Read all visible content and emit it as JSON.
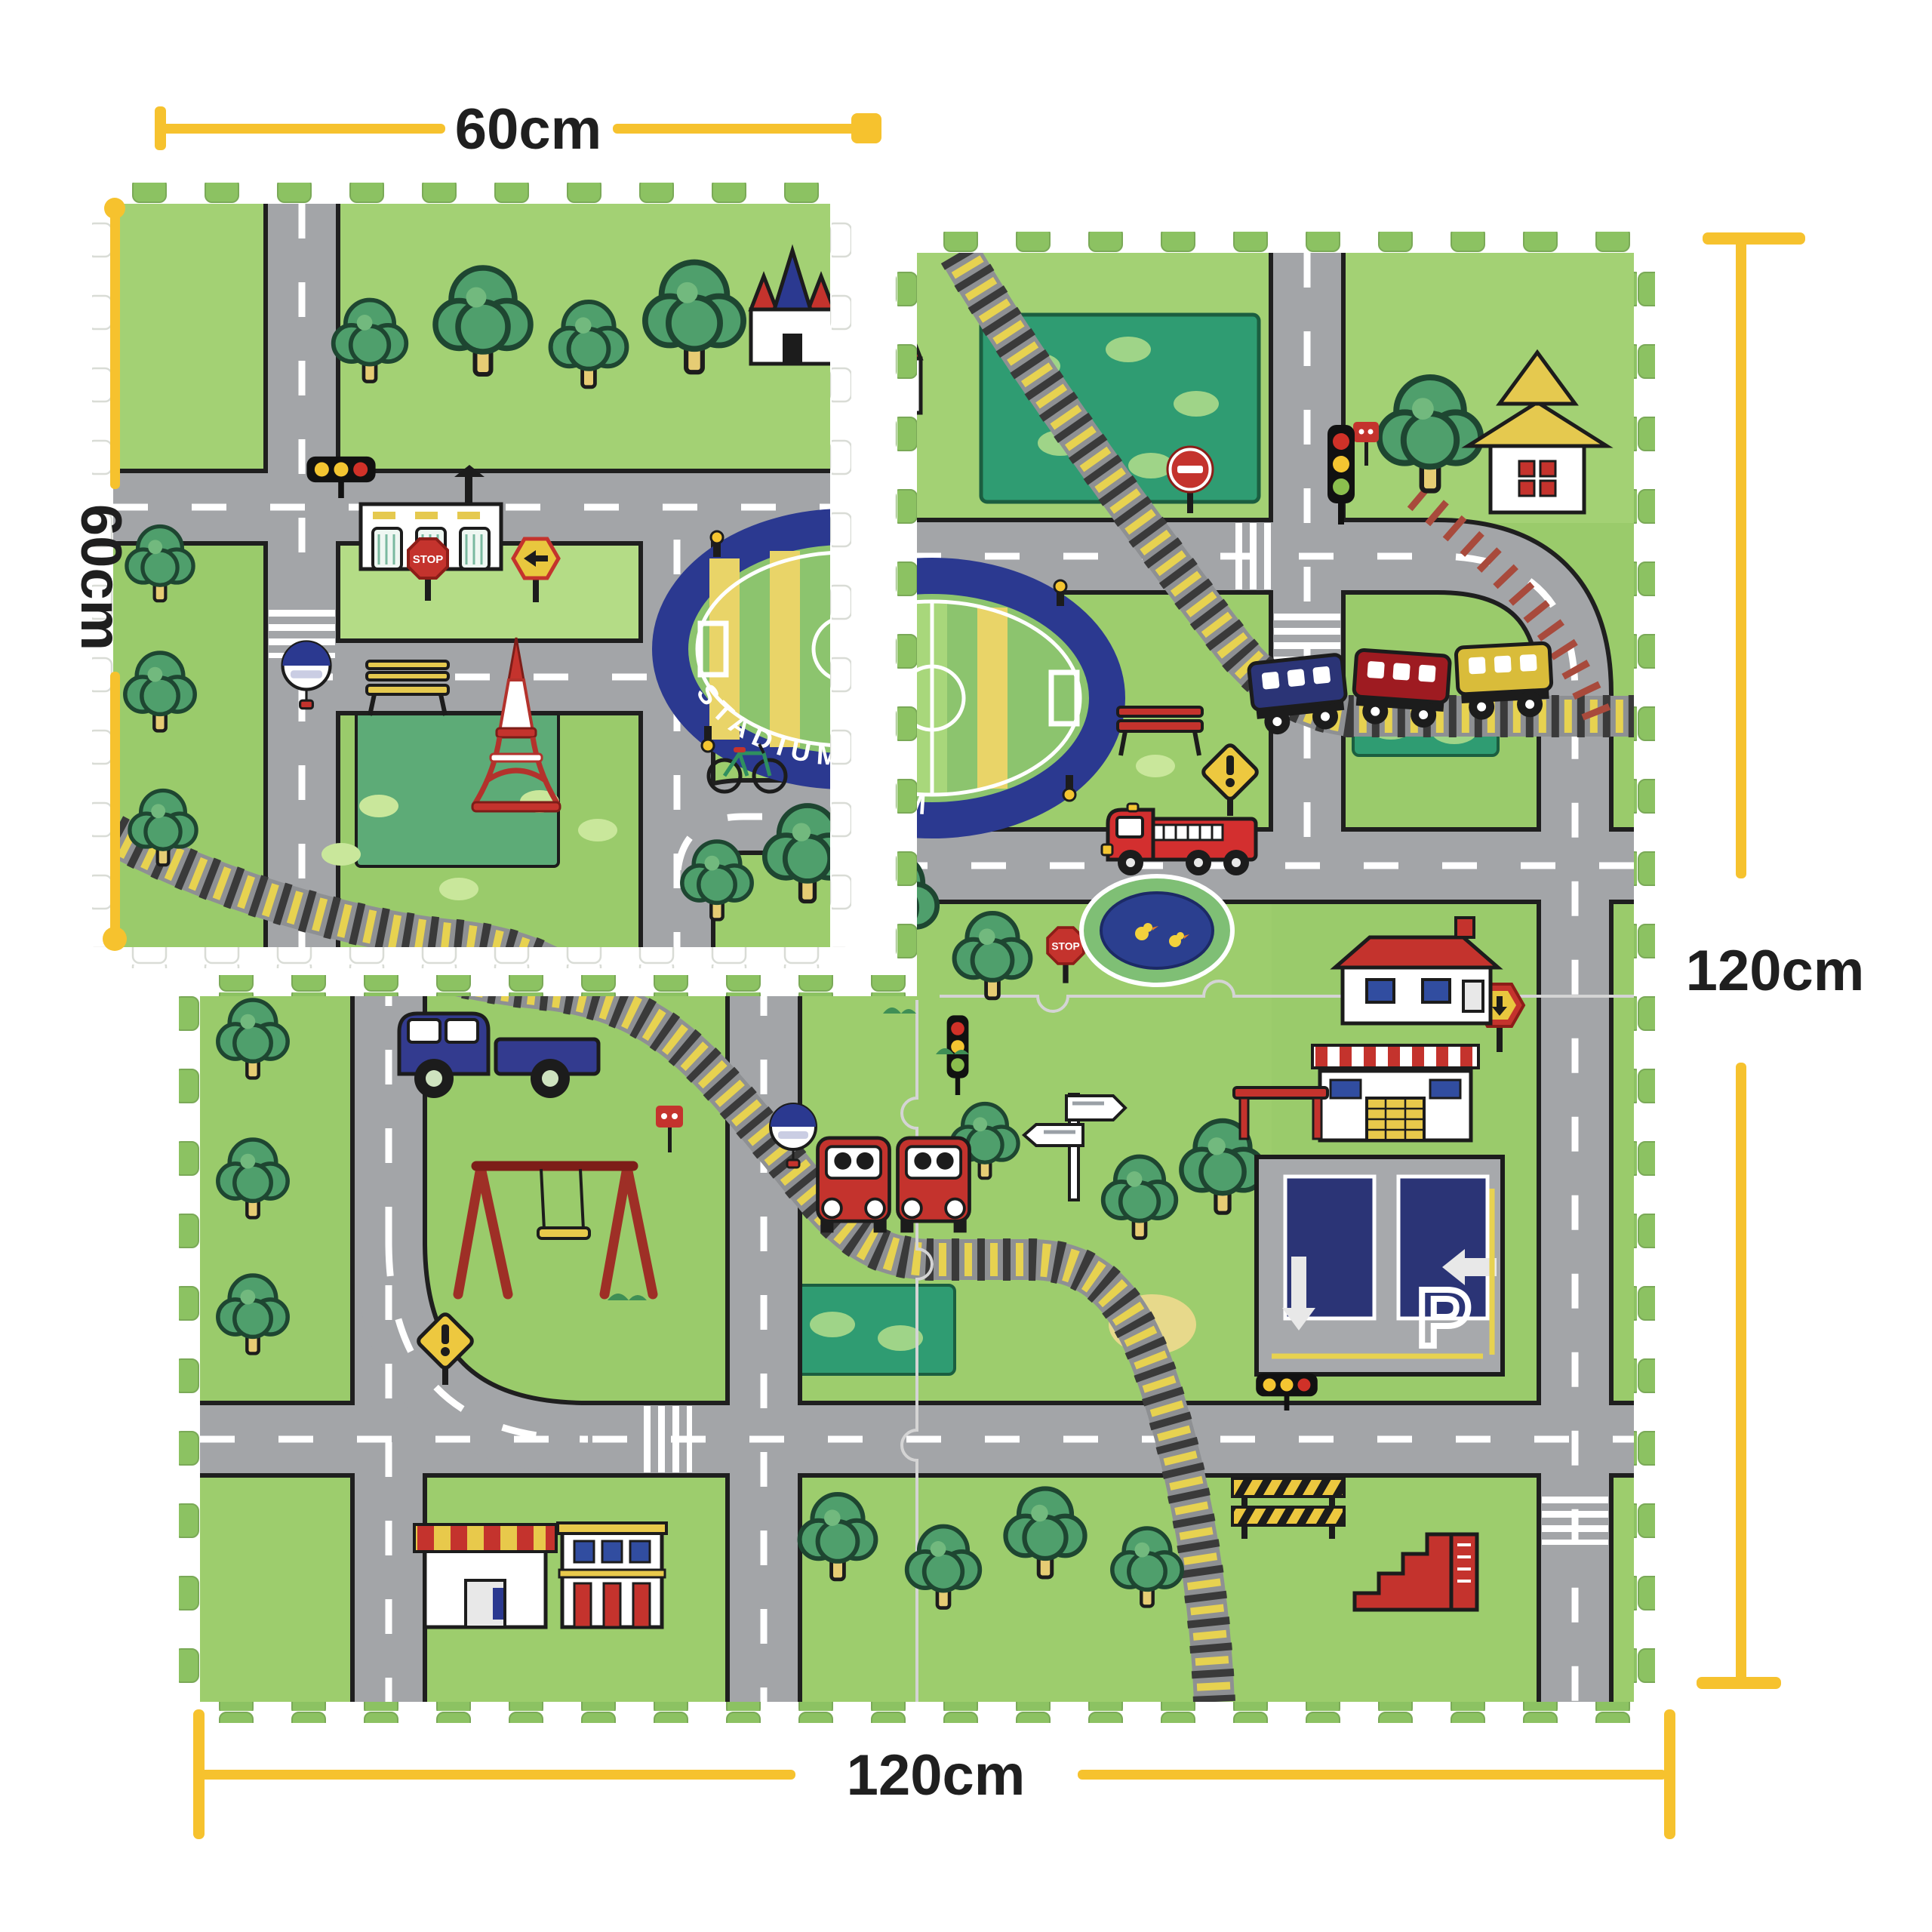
{
  "product": {
    "type": "foam-puzzle-play-mat",
    "scene": "city-roads-playmat"
  },
  "dimension_labels": {
    "top_width": "60cm",
    "left_height": "60cm",
    "right_height": "120cm",
    "bottom_width": "120cm"
  },
  "mat_art": {
    "stadium_banner": "STADIUM",
    "parking_letter": "P",
    "stop_sign": "STOP"
  },
  "colors": {
    "background": "#FFFFFF",
    "dimension_yellow": "#F6C22E",
    "label_black": "#1F1F1F",
    "grass_green": "#9ACB6B",
    "grass_light": "#B4DC86",
    "park_teal": "#2F9C72",
    "road_gray": "#A3A5A8",
    "rail_tie_yellow": "#E7D250",
    "stadium_navy": "#2B3990",
    "accent_red": "#C4332D",
    "sign_yellow": "#EDC83F",
    "foam_white": "#FFFFFF"
  }
}
